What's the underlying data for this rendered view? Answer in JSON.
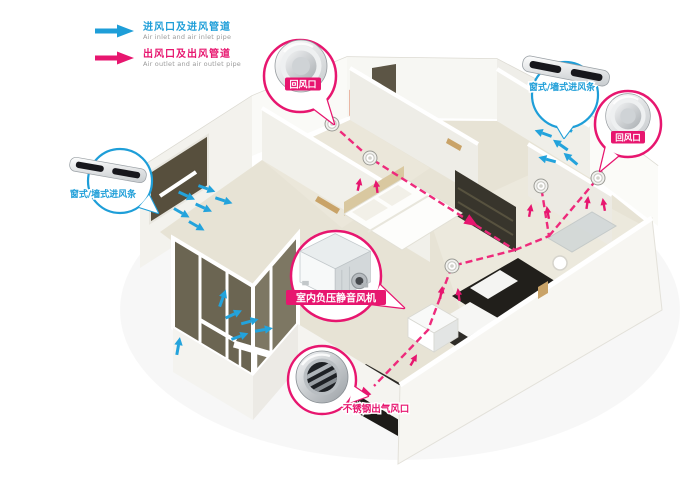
{
  "legend": {
    "items": [
      {
        "id": "inlet",
        "label": "进风口及进风管道",
        "sublabel": "Air inlet and air inlet pipe",
        "color": "#1e9ed8"
      },
      {
        "id": "outlet",
        "label": "出风口及出风管道",
        "sublabel": "Air outlet and air outlet pipe",
        "color": "#e7166f"
      }
    ]
  },
  "callouts": {
    "top_return": {
      "label": "回风口",
      "device": "round-ceiling-vent",
      "color": "#e7166f"
    },
    "right_return": {
      "label": "回风口",
      "device": "round-ceiling-vent",
      "color": "#e7166f"
    },
    "left_inlet": {
      "label": "窗式/墙式进风条",
      "device": "wall-inlet-strip",
      "color": "#1e9ed8"
    },
    "right_inlet": {
      "label": "窗式/墙式进风条",
      "device": "wall-inlet-strip",
      "color": "#1e9ed8"
    },
    "fan": {
      "label": "室内负压静音风机",
      "device": "inline-silent-fan",
      "color": "#e7166f"
    },
    "outlet": {
      "label": "不锈钢出气风口",
      "device": "stainless-outlet-vent",
      "color": "#e7166f"
    }
  },
  "icons": {
    "inlet_arrow": "block-arrow-right-blue",
    "outlet_arrow": "block-arrow-right-pink"
  },
  "colors": {
    "inlet_blue": "#1e9ed8",
    "outlet_pink": "#e7166f",
    "floor_beige": "#e7e3d5",
    "wall_white": "#f7f6f2",
    "glass_dark": "#675f4c"
  }
}
